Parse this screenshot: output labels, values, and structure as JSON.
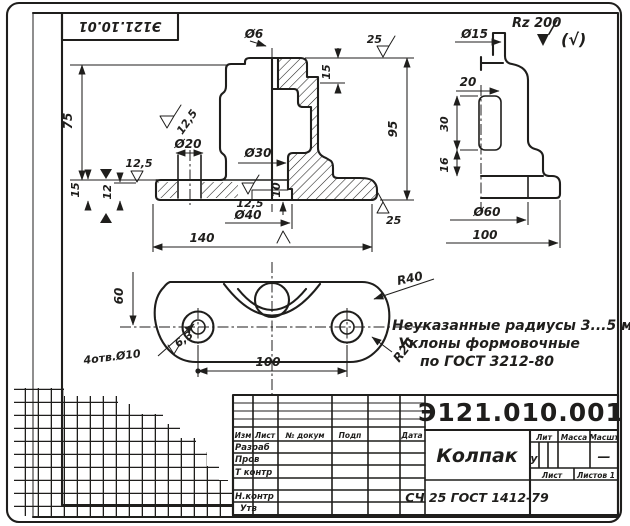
{
  "colors": {
    "paper": "#f7f5f0",
    "ink": "#1f1e1c"
  },
  "stamp": {
    "code": "Э121.10.01"
  },
  "front_view": {
    "dia6": "Ø6",
    "rough_top": "25",
    "step15": "15",
    "height75": "75",
    "rough_boss": "12,5",
    "dia20": "Ø20",
    "rough_flange_left": "12,5",
    "left15": "15",
    "left12": "12",
    "dia30": "Ø30",
    "height95": "95",
    "depth10": "10",
    "rough_recess": "12,5",
    "dia40": "Ø40",
    "width140": "140",
    "rough_base": "25"
  },
  "side_view": {
    "rz": "Rz 200",
    "all_surfaces": "(√)",
    "dia15": "Ø15",
    "width20": "20",
    "height30": "30",
    "height16": "16",
    "dia60": "Ø60",
    "width100": "100"
  },
  "plan_view": {
    "offset60": "60",
    "radius40": "R40",
    "holes": "4отв.Ø10",
    "rough_holes": "6,3",
    "spacing100": "100",
    "radius20": "R20"
  },
  "notes": {
    "line1": "Неуказанные радиусы 3...5 мм",
    "line2": "Уклоны формовочные",
    "line3": "по ГОСТ 3212-80"
  },
  "title_block": {
    "doc_number": "Э121.010.001",
    "part_name": "Колпак",
    "material": "СЧ 25 ГОСТ 1412-79",
    "col_izm": "Изм",
    "col_list": "Лист",
    "col_dokum": "№ докум",
    "col_podp": "Подп",
    "col_data": "Дата",
    "row_razrab": "Разраб",
    "row_prov": "Пров",
    "row_tkontr": "Т контр",
    "row_nkontr": "Н.контр",
    "row_utv": "Утв",
    "lit_label": "Лит",
    "massa_label": "Масса",
    "masshtab_label": "Масшт",
    "lit_value": "у",
    "masshtab_value": "—",
    "list_label": "Лист",
    "listov_label": "Листов 1"
  }
}
